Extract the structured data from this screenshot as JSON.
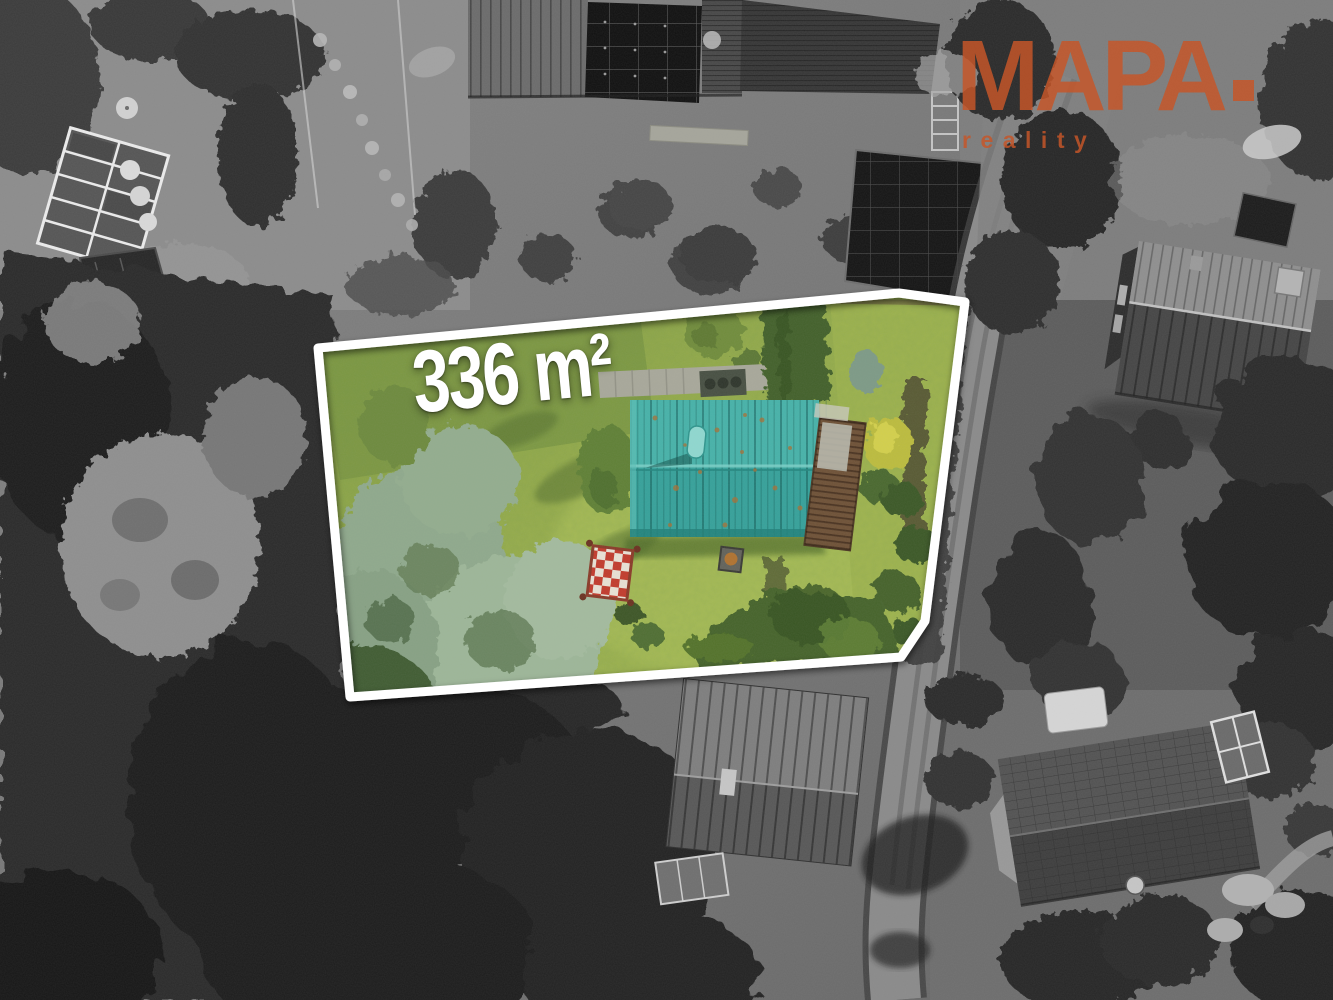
{
  "scene": {
    "description": "Aerial drone photo of a garden plot for sale: surroundings shown in black and white, the offered 336 m2 plot with a teal-roofed cabin shown in color and outlined in white"
  },
  "property": {
    "area_label": "336 m²"
  },
  "logo": {
    "brand": "MAPA",
    "dot_icon": "square-dot",
    "subtitle": "reality"
  },
  "colors": {
    "plot_outline": "#ffffff",
    "cabin_roof_teal": "#3aa69e",
    "lawn_green": "#95ab4a",
    "brand_orange": "#c7562b"
  }
}
